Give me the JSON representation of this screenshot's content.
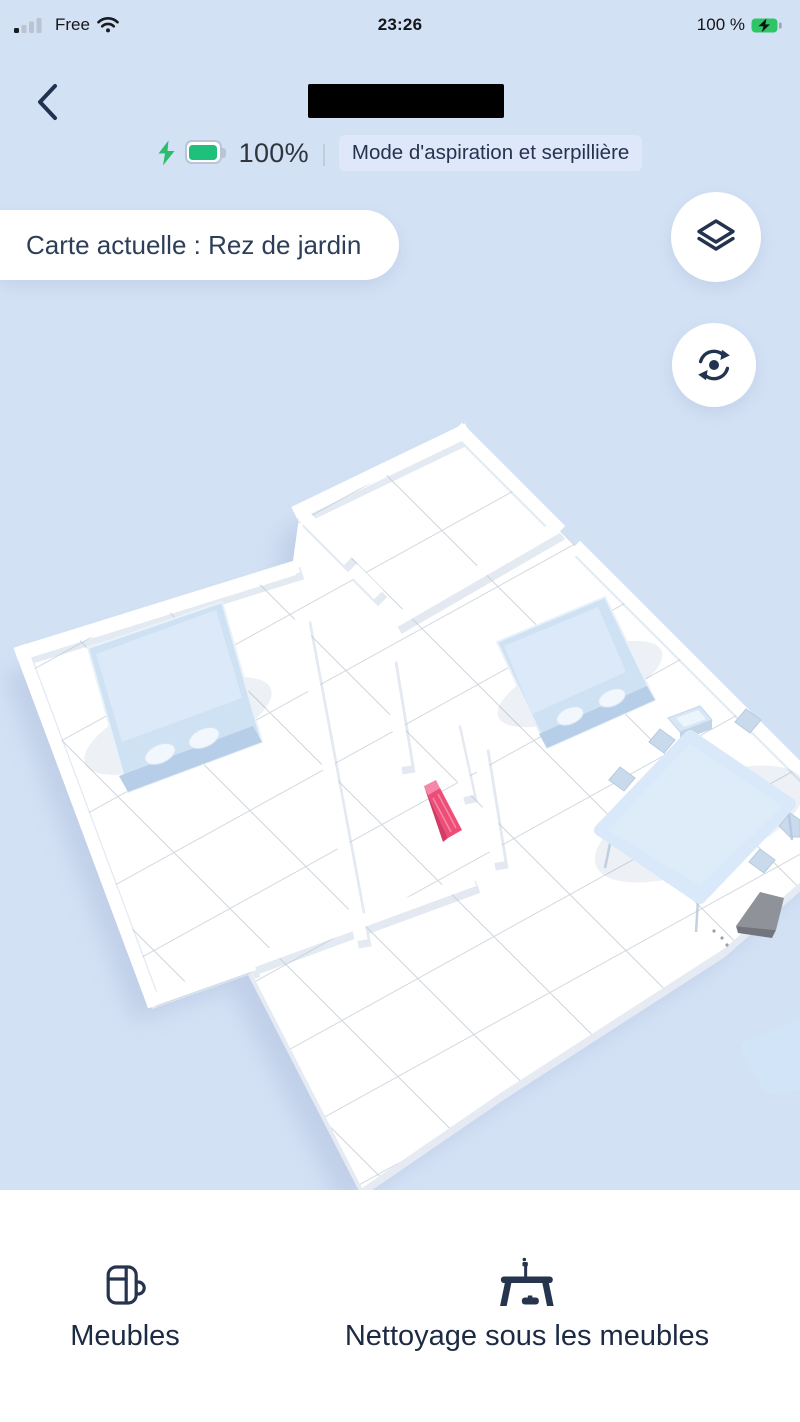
{
  "status_bar": {
    "carrier": "Free",
    "time": "23:26",
    "battery_percent": "100 %"
  },
  "header": {
    "title_redacted": true
  },
  "device_status": {
    "battery_level": "100%",
    "divider": "|",
    "mode_badge": "Mode d'aspiration et serpillière"
  },
  "map": {
    "current_map_label": "Carte actuelle : Rez de jardin",
    "controls": [
      {
        "name": "map-layers-button",
        "icon": "layers-icon"
      },
      {
        "name": "map-rotate-button",
        "icon": "rotate-icon"
      }
    ],
    "scene_objects": [
      "bed-left-room",
      "bed-right-room",
      "nightstand",
      "dining-table",
      "six-chairs",
      "rug",
      "pink-obstacle",
      "gray-object"
    ],
    "colors": {
      "background": "#d3e1f5",
      "floor": "#ffffff",
      "grid_line": "#c5ced9",
      "furniture_blue": "#cfe2f4",
      "obstacle_pink": "#ee4d78",
      "object_gray": "#8f9399"
    }
  },
  "bottom_bar": {
    "items": [
      {
        "label": "Meubles",
        "icon": "furniture-icon"
      },
      {
        "label": "Nettoyage sous les meubles",
        "icon": "under-furniture-cleaning-icon"
      }
    ]
  },
  "theme": {
    "accent_text": "#25334f",
    "badge_bg": "#dfe7fb",
    "battery_green": "#1fbf7c",
    "status_text": "#15161a"
  }
}
